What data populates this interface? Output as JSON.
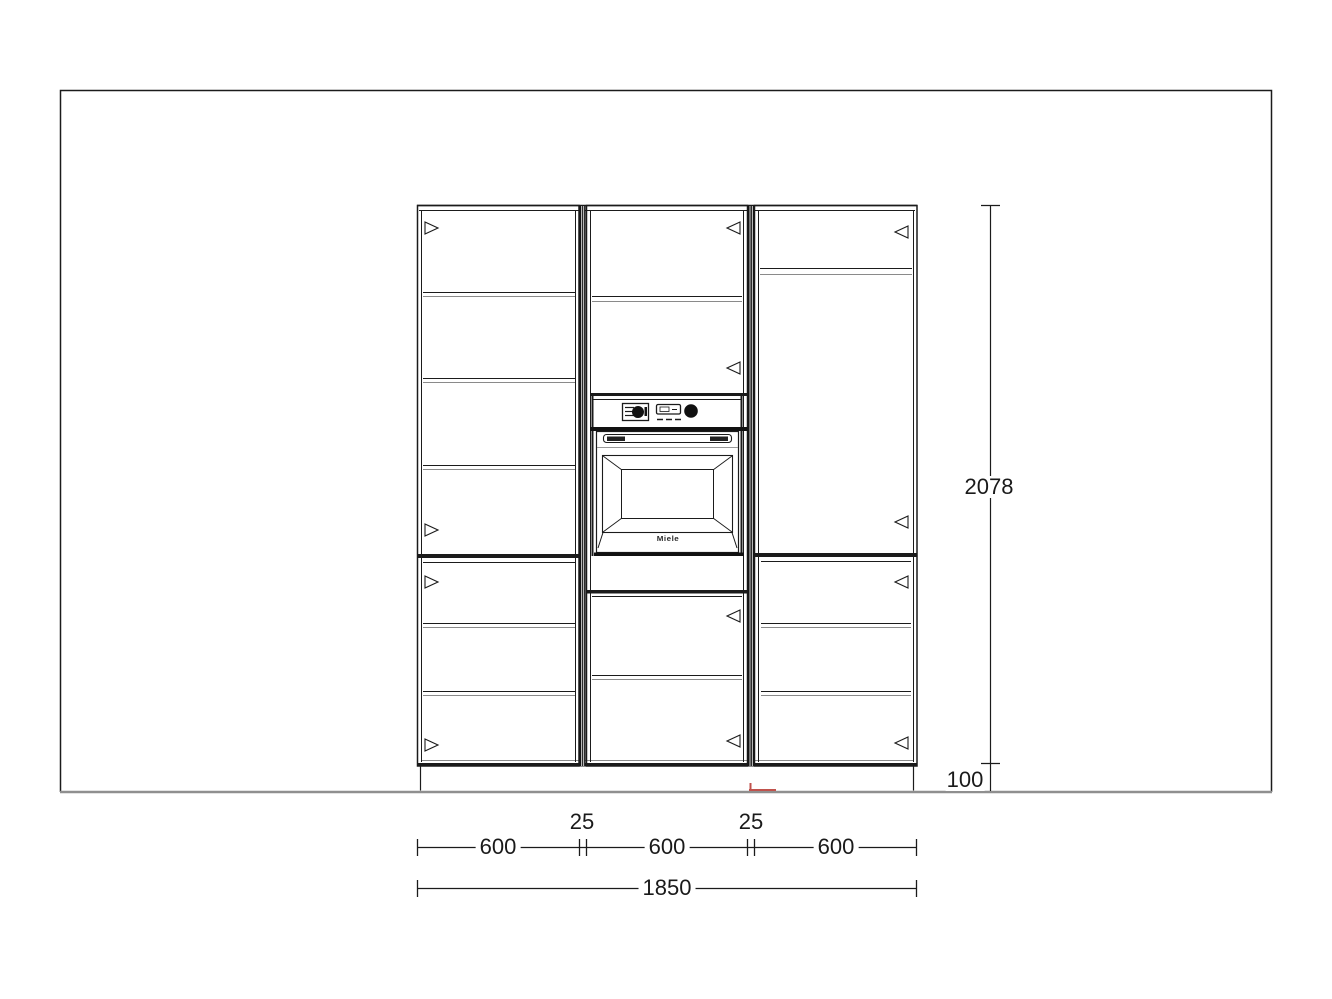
{
  "drawing": {
    "dimensions": {
      "widths": {
        "segments": [
          "600",
          "600",
          "600"
        ],
        "gaps": [
          "25",
          "25"
        ],
        "total": "1850"
      },
      "heights": {
        "overall": "2078",
        "plinth": "100"
      }
    },
    "oven": {
      "brand": "Miele"
    },
    "colors": {
      "line": "#1b1b1b",
      "soft_line": "#8a8a8a",
      "floor_line": "#8f8f8f",
      "marker_red": "#c0524c",
      "background": "#ffffff"
    }
  }
}
